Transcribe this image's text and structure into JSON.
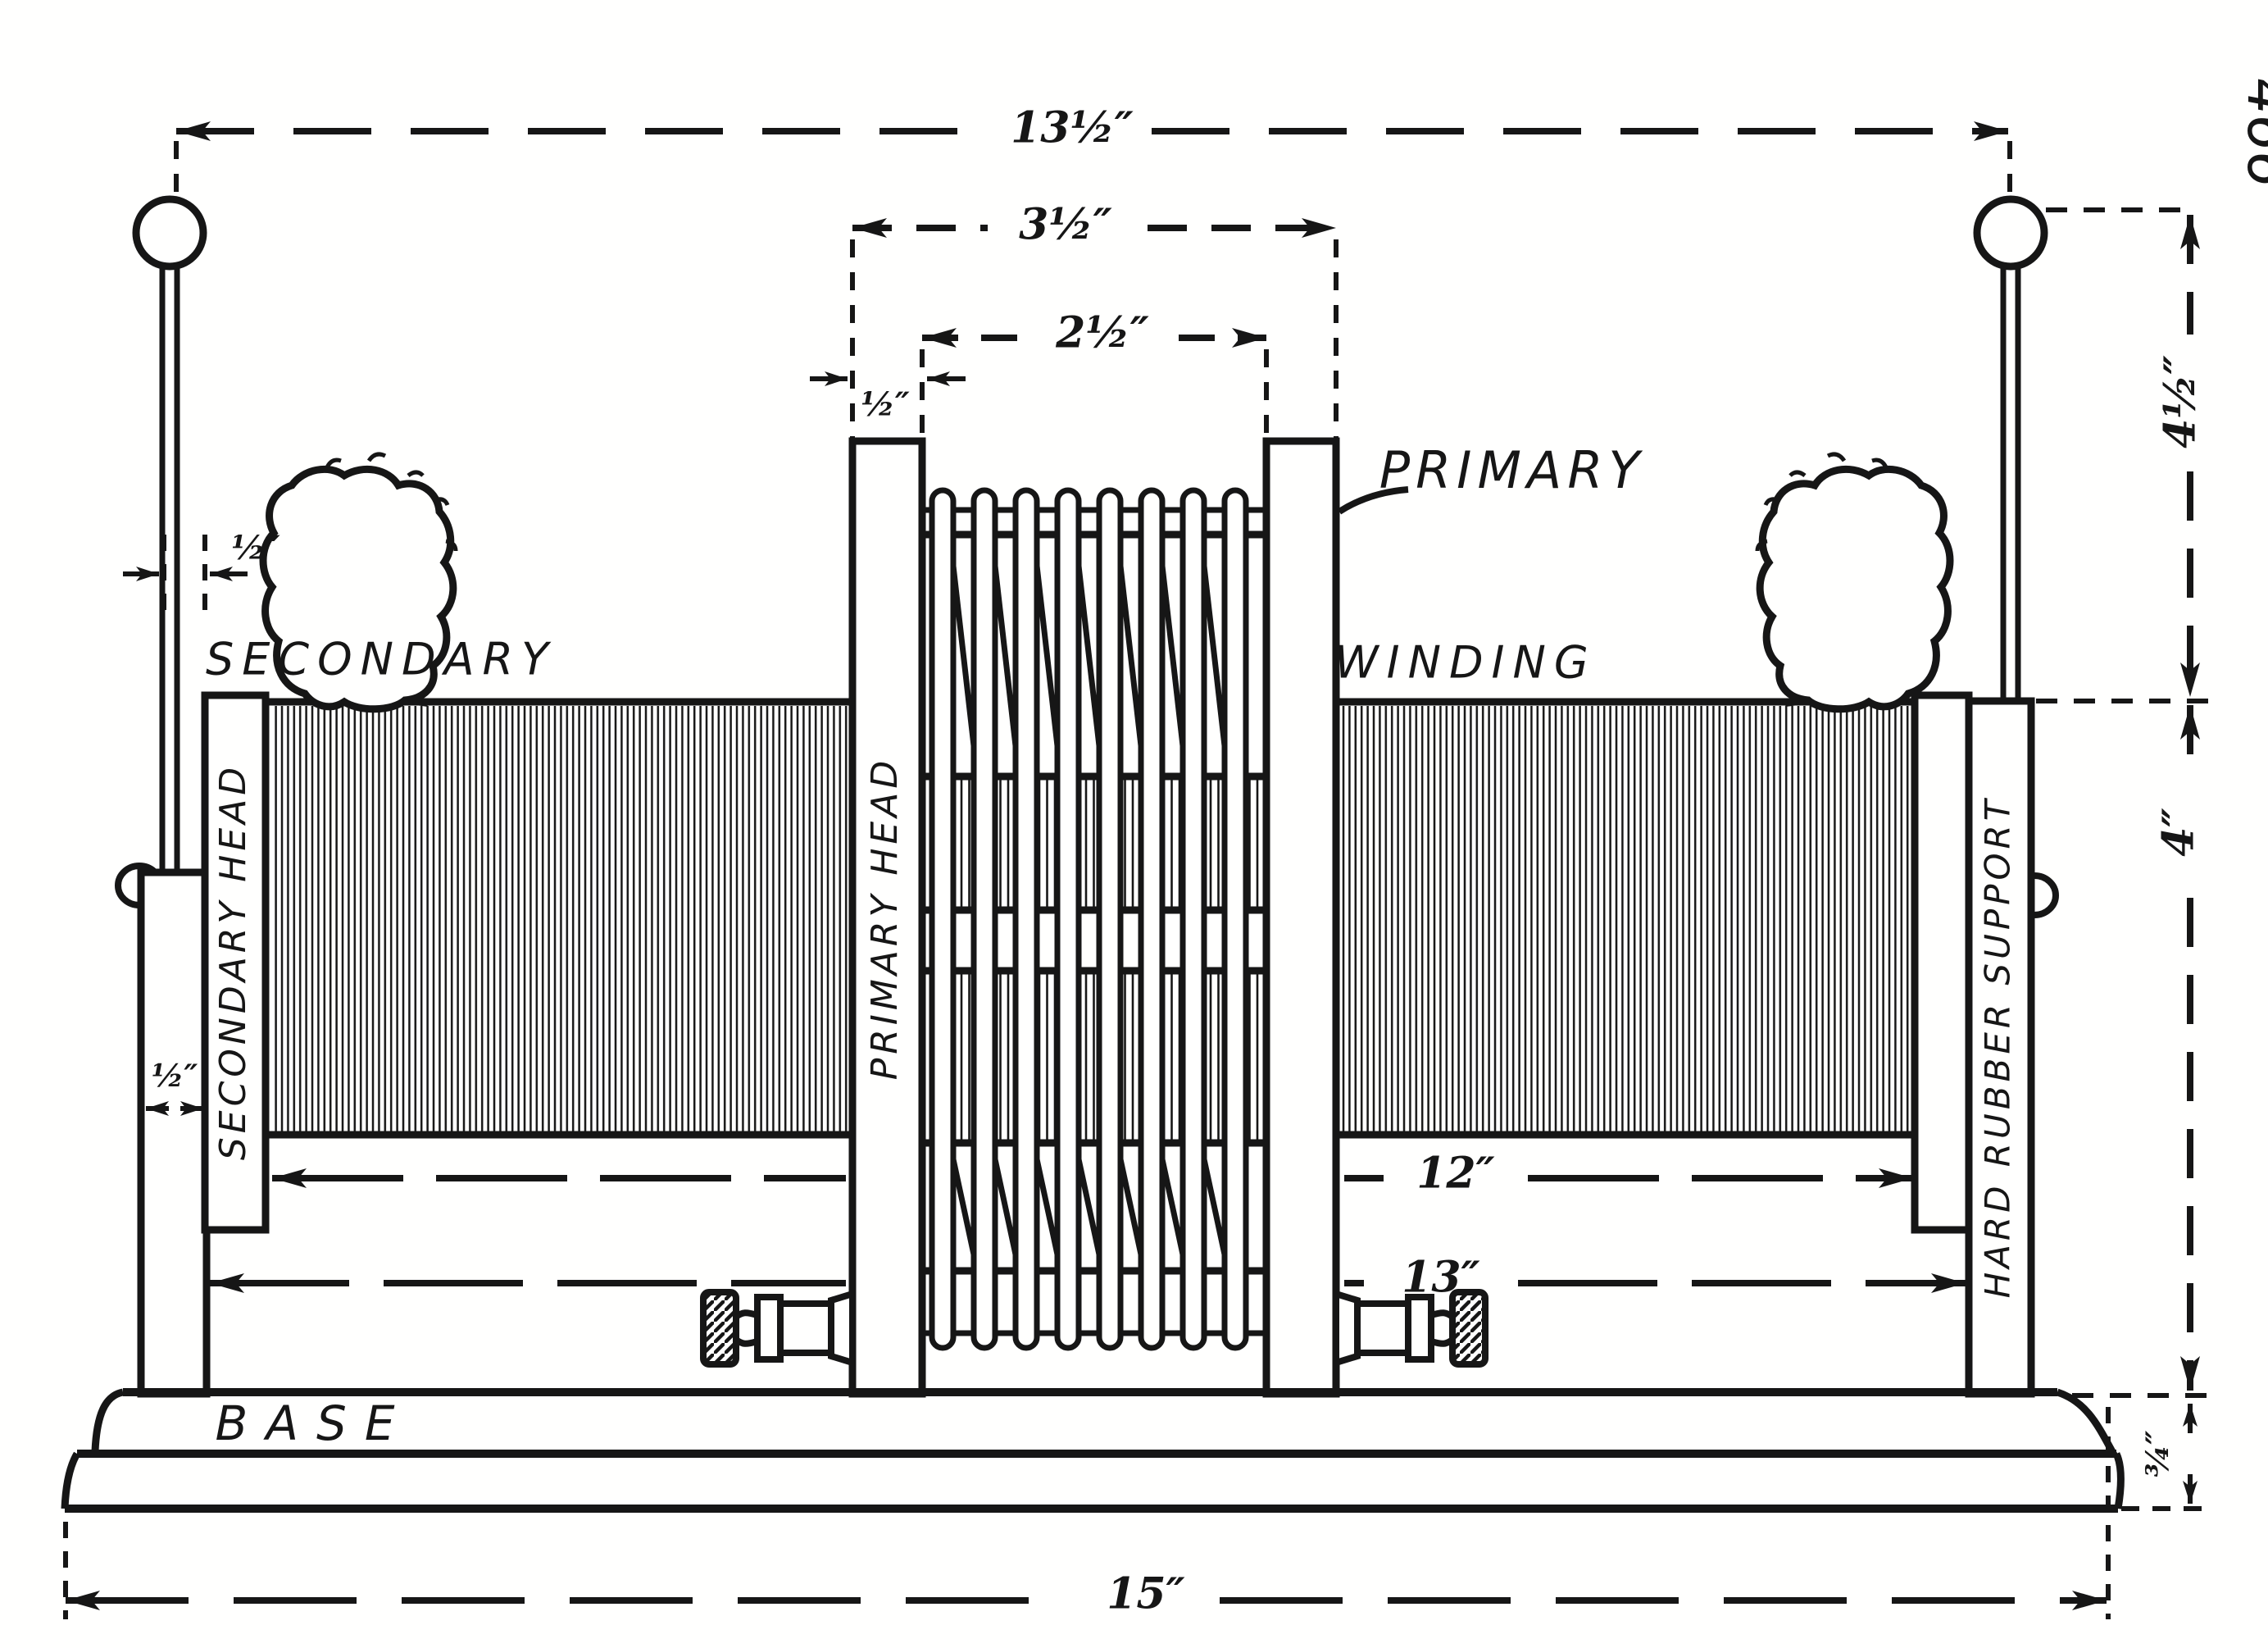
{
  "figure": {
    "page_number": "466",
    "part_labels": {
      "primary": "PRIMARY",
      "winding": "WINDING",
      "secondary": "SECONDARY",
      "secondary_head": "SECONDARY HEAD",
      "primary_head": "PRIMARY HEAD",
      "hard_rubber_support": "HARD RUBBER SUPPORT",
      "base": "BASE"
    },
    "dimensions": {
      "overall_width": "13½″",
      "primary_outer_width": "3½″",
      "primary_inner_width": "2½″",
      "primary_head_thickness": "½″",
      "rod_gap": "½″",
      "support_thickness": "½″",
      "winding_length": "12″",
      "support_span": "13″",
      "base_length": "15″",
      "terminal_height": "4½″",
      "support_height": "4″",
      "base_height": "¾″"
    }
  }
}
